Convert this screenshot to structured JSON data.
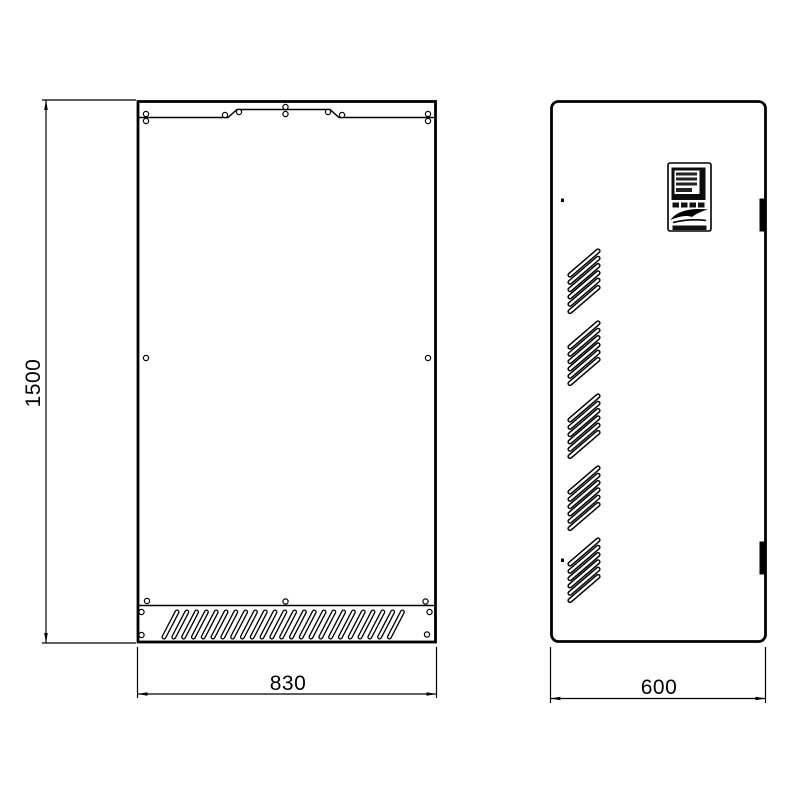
{
  "drawing": {
    "type": "technical-drawing",
    "subject": "wall-mounted electrical enclosure, front and side elevations",
    "colors": {
      "line": "#000000",
      "background": "#ffffff",
      "hinge_fill": "#000000"
    },
    "labels": {
      "height": "1500",
      "width": "830",
      "depth": "600"
    },
    "front_view": {
      "name": "front-elevation",
      "height_dimension": "1500",
      "width_dimension": "830",
      "features": [
        "top-mounting-bracket",
        "screw-holes",
        "bottom-ventilation-grille"
      ]
    },
    "side_view": {
      "name": "side-elevation",
      "depth_dimension": "600",
      "features": [
        "control-panel-display",
        "ventilation-louver-groups",
        "door-hinges"
      ],
      "louver_group_count": 5,
      "hinge_count": 2
    }
  }
}
